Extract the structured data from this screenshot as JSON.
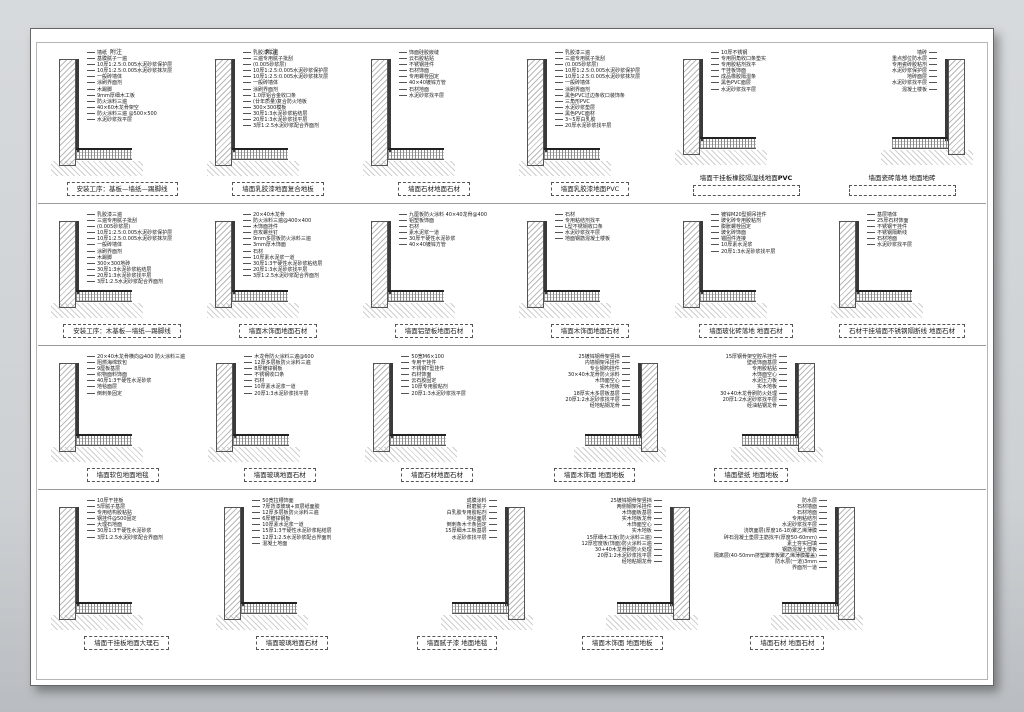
{
  "colors": {
    "background": "#cdd1d4",
    "sheet": "#ffffff",
    "line": "#555555",
    "hatch": "#b9b9b9"
  },
  "rows": [
    {
      "details": [
        {
          "title": "安装工序：基板—墙纸—踢脚线",
          "side": "left",
          "top_label": "附注",
          "annotations": [
            "墙纸",
            "基膜腻子一遍",
            "10厚1:2.5:0.005水泥砂浆保护层",
            "10厚1:2.5:0.005水泥砂浆抹灰层",
            "一般砖墙体",
            "涂刷界面剂",
            "木踢脚",
            "9mm厚细木工板",
            "防火涂料三遍",
            "40×60木龙骨架空",
            "防火涂料三遍 @500×500",
            "水泥砂浆找平层"
          ]
        },
        {
          "title": "墙面乳胶漆地面复合地板",
          "side": "left",
          "top_label": "附注",
          "annotations": [
            "乳胶漆三遍",
            "三遍专用腻子批刮",
            "(0.005砂浆层)",
            "10厚1:2.5:0.005水泥砂浆保护层",
            "10厚1:2.5:0.005水泥砂浆抹灰层",
            "一般砖墙体",
            "涂刷界面剂",
            "1.0厚铝合金收口条",
            "(廿年质量)复合防火地板",
            "300×300模板",
            "30厚1:3水泥砂浆粘结层",
            "20厚1:3水泥砂浆找平层",
            "3厚1:2.5水泥砂浆配合界面剂"
          ]
        },
        {
          "title": "墙面石材地面石材",
          "side": "left",
          "annotations": [
            "饰面硅胶嵌缝",
            "云石胶粘贴",
            "不锈钢挂件",
            "石材饰面",
            "专用螺栓固定",
            "40×40镀锌方管",
            "石材地面",
            "水泥砂浆找平层"
          ]
        },
        {
          "title": "墙面乳胶漆地面PVC",
          "side": "left",
          "annotations": [
            "乳胶漆三遍",
            "三遍专用腻子批刮",
            "(0.005砂浆层)",
            "10厚1:2.5:0.005水泥砂浆保护层",
            "10厚1:2.5:0.005水泥砂浆抹灰层",
            "一般砖墙体",
            "涂刷界面剂",
            "黑色PVC过边条收口装饰条",
            "三角形PVC",
            "水泥砂浆垫层",
            "黑色PVC面材",
            "3~5厚白乳胶",
            "20厚水泥砂浆找平层"
          ]
        },
        {
          "title": "墙面干挂板橡胶隔湿线地面",
          "title_bold": "PVC",
          "side": "left",
          "label_above_box": true,
          "annotations": [
            "10厚不锈钢",
            "专用阴角收口条垫实",
            "专用胶粘剂找平",
            "干挂板饰面",
            "成品橡胶隔湿条",
            "黑色PVC面层",
            "水泥砂浆找平层"
          ]
        },
        {
          "title": "墙面瓷砖落地 地面地砖",
          "side": "right",
          "label_above_box": true,
          "annotations": [
            "墙砖",
            "重点部位防水层",
            "专用瓷砖胶粘剂",
            "水泥砂浆保护层",
            "地砖面层",
            "水泥砂浆找平层",
            "混凝土楼板"
          ]
        }
      ]
    },
    {
      "details": [
        {
          "title": "安装工序：木基板—墙纸—踢脚线",
          "side": "left",
          "annotations": [
            "乳胶漆三遍",
            "三遍专用腻子批刮",
            "(0.005砂浆层)",
            "10厚1:2.5:0.005水泥砂浆保护层",
            "10厚1:2.5:0.005水泥砂浆抹灰层",
            "一般砖墙体",
            "涂刷界面剂",
            "木踢脚",
            "300×300地砖",
            "30厚1:3水泥砂浆粘结层",
            "20厚1:3水泥砂浆找平层",
            "3厚1:2.5水泥砂浆配合界面剂"
          ]
        },
        {
          "title": "墙面木饰面地面石材",
          "side": "left",
          "annotations": [
            "20×40木龙骨",
            "防火涂料三遍@400×400",
            "木饰面挂件",
            "自攻螺丝钉",
            "9mm多层板防火涂料三遍",
            "3mm厚木饰面",
            "石材",
            "10厚素水泥浆一道",
            "30厚1:3干硬性水泥砂浆粘结层",
            "20厚1:3水泥砂浆找平层",
            "3厚1:2.5水泥砂浆配合界面剂"
          ]
        },
        {
          "title": "墙面铝塑板地面石材",
          "side": "left",
          "annotations": [
            "九厘板防火涂料 40×40龙骨@400",
            "铝塑板饰面",
            "石材",
            "素水泥浆一道",
            "30厚干硬性水泥砂浆",
            "40×40镀锌方管"
          ]
        },
        {
          "title": "墙面木饰面地面石材",
          "side": "left",
          "annotations": [
            "石材",
            "专用粘结剂找平",
            "L型不锈钢收口条",
            "水泥砂浆找平层",
            "地面钢筋混凝土楼板"
          ]
        },
        {
          "title": "墙面玻化砖落地 地面石材",
          "side": "left",
          "annotations": [
            "镀锌M20型钢吊挂件",
            "玻化砖专用胶粘剂",
            "膨胀螺栓固定",
            "玻化砖饰面",
            "锚固件连接",
            "10厚素水泥浆",
            "20厚1:3水泥砂浆找平层"
          ]
        },
        {
          "title": "石材干挂墙面不锈钢隔断线 地面石材",
          "side": "left",
          "annotations": [
            "基层墙体",
            "25厚石材饰面",
            "不锈钢干挂件",
            "不锈钢隔断线",
            "石材地面",
            "水泥砂浆找平层"
          ]
        }
      ]
    },
    {
      "details": [
        {
          "title": "墙面软包地面地毯",
          "side": "left",
          "annotations": [
            "20×40木龙骨横向@400 防火涂料三遍",
            "阻燃海绵软包",
            "9厘板基层",
            "织物面料饰面",
            "40厚1:3干硬性水泥砂浆",
            "地毯面层",
            "倒刺条固定"
          ]
        },
        {
          "title": "墙面玻璃地面石材",
          "side": "left",
          "annotations": [
            "木龙骨防火涂料三遍@600",
            "12厚多层板防火涂料三遍",
            "8厚镀锌钢板",
            "不锈钢收口条",
            "石材",
            "10厚素水泥浆一道",
            "20厚1:3水泥砂浆找平层"
          ]
        },
        {
          "title": "墙面石材地面石材",
          "side": "left",
          "annotations": [
            "50宽M6×100",
            "专用干挂件",
            "不锈钢T型挂件",
            "石材饰面",
            "云石胶固定",
            "10厚专用胶粘剂",
            "20厚1:3水泥砂浆找平层"
          ]
        },
        {
          "title": "墙面木饰面 地面地板",
          "side": "right",
          "annotations": [
            "25镀锌钢骨架竖挡",
            "内墙钢架吊挂件",
            "专业钢构挂件",
            "30×40木龙骨防火涂料",
            "木饰面空心",
            "实木地板",
            "18厚实木多层板基层",
            "20厚1:2水泥砂浆找平层",
            "经地粘钢龙骨"
          ]
        },
        {
          "title": "墙面壁纸 地面地板",
          "side": "right",
          "annotations": [
            "15厚钢骨架空腔吊挂件",
            "壁纸饰面基层",
            "专用胶粘贴",
            "木饰面空心",
            "水泥压力板",
            "实木地板",
            "30+40木龙骨刷防火处理",
            "20厚1:2水泥砂浆找平层",
            "经油粘钢龙骨"
          ]
        }
      ]
    },
    {
      "details": [
        {
          "title": "墙面干挂板地面大理石",
          "side": "left",
          "annotations": [
            "10厚干挂板",
            "5厚腻子基层",
            "专用结构胶粘贴",
            "钢挂件@500固定",
            "大理石地面",
            "30厚1:3干硬性水泥砂浆",
            "3厚1:2.5水泥砂浆配合界面剂"
          ]
        },
        {
          "title": "墙面玻璃地面石材",
          "side": "left",
          "annotations": [
            "50宽拉槽饰面",
            "7厚背漆玻璃+双层纸面胶",
            "12厚多层板防火涂料三遍",
            "6厚镀锌钢板",
            "10厚素水泥浆一道",
            "15厚1:3干硬性水泥砂浆粘结层",
            "12厚1:2.5水泥砂浆配合界面剂",
            "混凝土地面"
          ]
        },
        {
          "title": "墙面腻子漆 地面地毯",
          "side": "right",
          "annotations": [
            "成膜涂料",
            "耐磨腻子",
            "白乳胶专用胶粘剂",
            "地毯面层",
            "倒刺条木卡条固定",
            "15厚细木工板基层",
            "水泥砂浆找平层"
          ]
        },
        {
          "title": "墙面木饰面 地面地板",
          "side": "right",
          "annotations": [
            "25镀锌钢骨架竖挡",
            "两侧钢架吊挂件",
            "木饰面板基层",
            "实木地板龙骨",
            "木饰面空心",
            "实木地板",
            "15厚细木工板(防火涂料三遍)",
            "12厚密度板(饰面)防火涂料三遍",
            "30+40木龙骨刷防火处理",
            "20厚1:2水泥砂浆找平层",
            "经地粘钢龙骨"
          ]
        },
        {
          "title": "墙面石材 地面石材",
          "side": "right",
          "annotations": [
            "防水层",
            "石材墙面",
            "石材地面",
            "专用粘结剂",
            "水泥砂浆找平层",
            "浇筑面层(厚度16-18)聚乙烯薄膜",
            "碎石混凝土垫层主筋找平(厚度50-60mm)",
            "素土夯实回填",
            "钢筋混凝土楼板",
            "隔离层(40-50mm挤塑聚苯板聚乙烯薄膜覆盖)",
            "防水层(一道)3mm",
            "界面剂一道"
          ]
        }
      ]
    }
  ]
}
